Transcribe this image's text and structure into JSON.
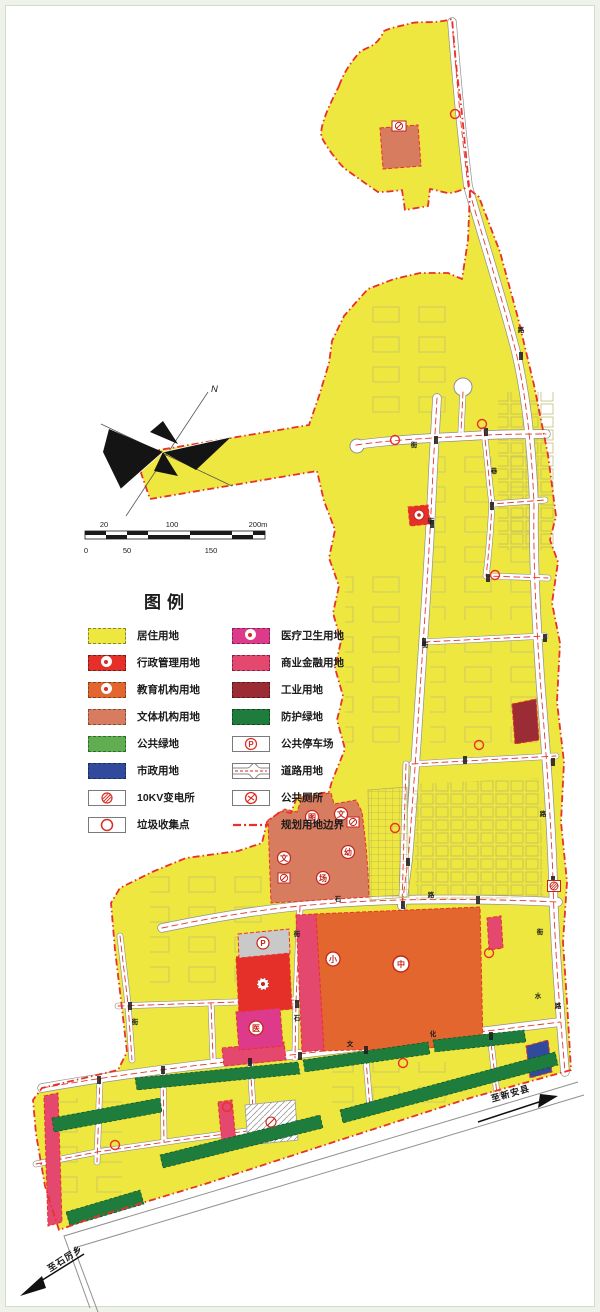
{
  "legend": {
    "title": "图例",
    "left": [
      {
        "label": "居住用地"
      },
      {
        "label": "行政管理用地"
      },
      {
        "label": "教育机构用地"
      },
      {
        "label": "文体机构用地"
      },
      {
        "label": "公共绿地"
      },
      {
        "label": "市政用地"
      },
      {
        "label": "10KV变电所"
      },
      {
        "label": "垃圾收集点"
      }
    ],
    "right": [
      {
        "label": "医疗卫生用地"
      },
      {
        "label": "商业金融用地"
      },
      {
        "label": "工业用地"
      },
      {
        "label": "防护绿地"
      },
      {
        "label": "公共停车场"
      },
      {
        "label": "道路用地"
      },
      {
        "label": "公共厕所"
      },
      {
        "label": "规划用地边界"
      }
    ]
  },
  "compass": {
    "north_label": "N"
  },
  "scalebar": {
    "top": [
      "20",
      "100",
      "200m"
    ],
    "bottom": [
      "0",
      "50",
      "150"
    ]
  },
  "directions": {
    "bottom_right": "至新安县",
    "bottom_left": "至石厉乡"
  },
  "map_labels": {
    "middle_school": "中",
    "primary_school": "小",
    "hospital": "医",
    "library": "图",
    "culture_a": "文",
    "kindergarten": "幼",
    "culture_b": "文",
    "sports_field": "场",
    "parking": "P"
  },
  "streets": [
    {
      "ch": "石"
    },
    {
      "ch": "路"
    },
    {
      "ch": "街"
    },
    {
      "ch": "石"
    },
    {
      "ch": "文"
    },
    {
      "ch": "化"
    },
    {
      "ch": "街"
    },
    {
      "ch": "水"
    },
    {
      "ch": "路"
    },
    {
      "ch": "街"
    },
    {
      "ch": "街"
    },
    {
      "ch": "巷"
    },
    {
      "ch": "路"
    },
    {
      "ch": "街"
    },
    {
      "ch": "路"
    },
    {
      "ch": "街"
    }
  ],
  "colors": {
    "residential": "#EDE73F",
    "administration": "#E43029",
    "education": "#E3662E",
    "culture_sports": "#D87C60",
    "public_green": "#60AD52",
    "municipal": "#324A9B",
    "medical": "#DD3A8C",
    "commercial_finance": "#E4486F",
    "industrial": "#9B2B35",
    "protective_green": "#1E7C3D",
    "boundary": "#E8312A"
  }
}
